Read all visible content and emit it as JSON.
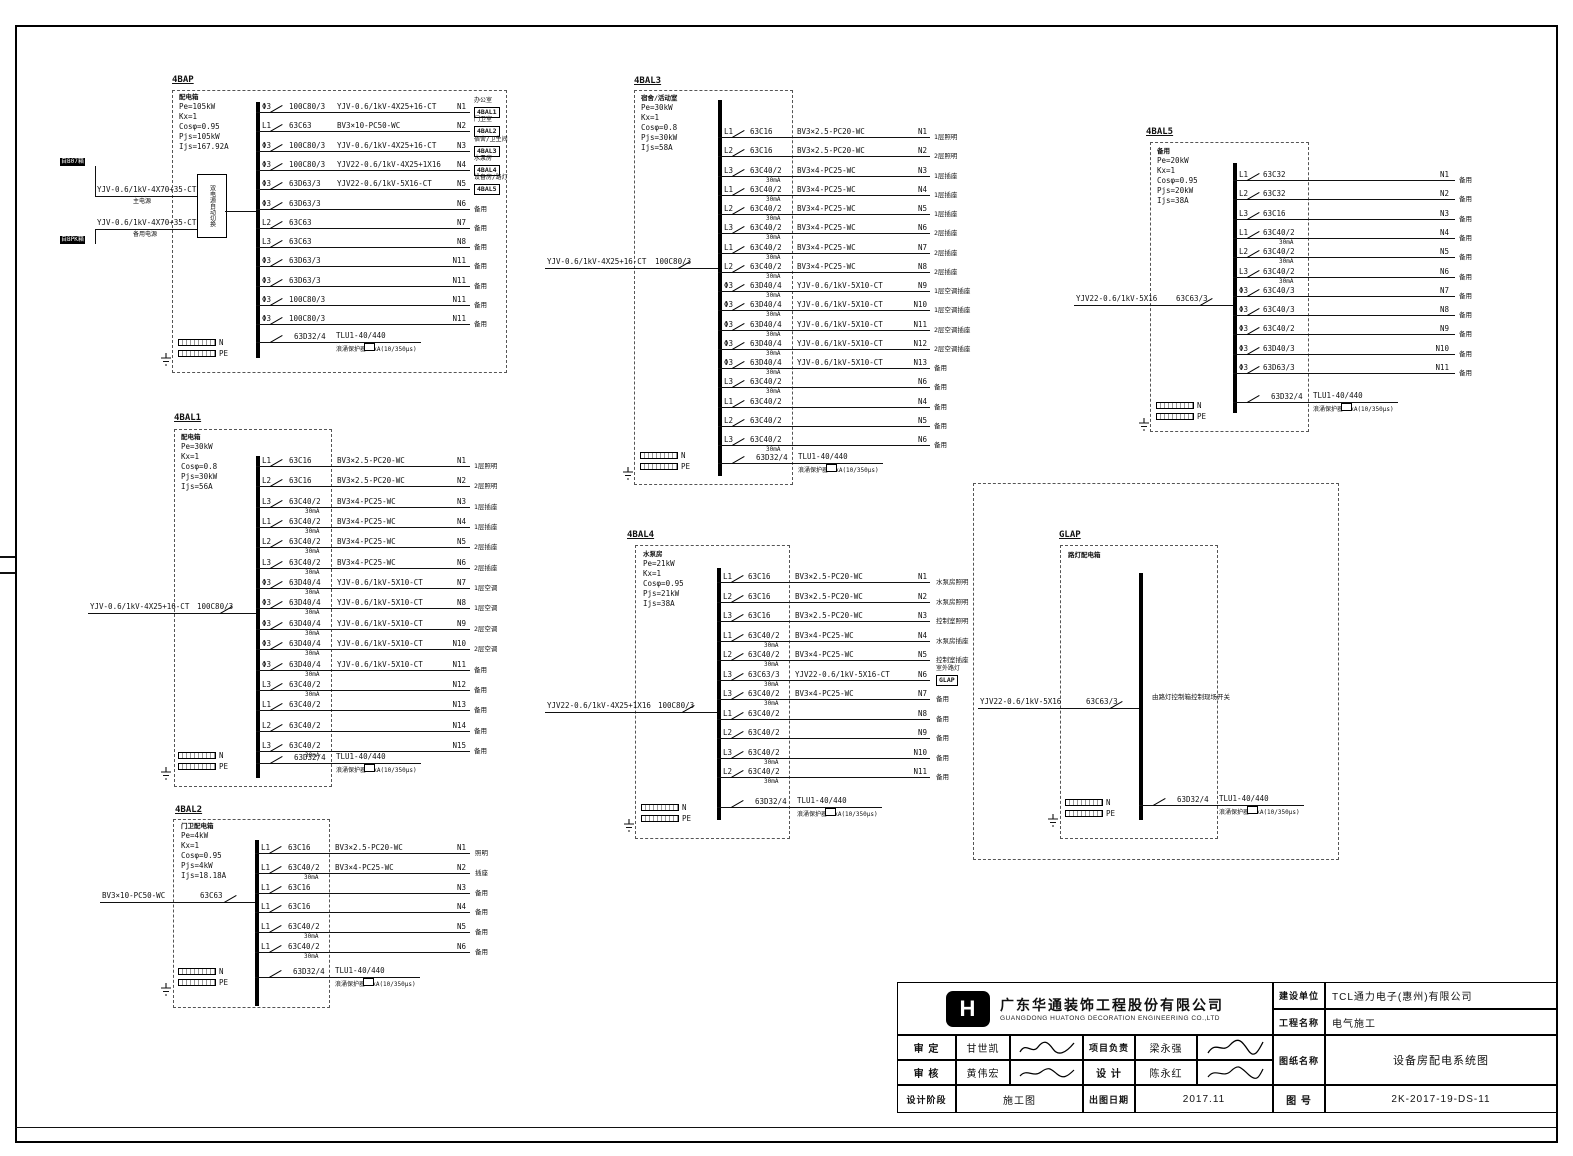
{
  "common": {
    "n": "N",
    "pe": "PE"
  },
  "panels": [
    {
      "id": "4BAP",
      "title": "4BAP",
      "name": "配电箱",
      "header": [
        "Pe=105kW",
        "Kx=1",
        "Cosφ=0.95",
        "Pjs=105kW",
        "Ijs=167.92A"
      ],
      "ats": "双电源自动切换",
      "incoming": [
        {
          "tag": "自B07箱",
          "cable": "YJV-0.6/1kV-4X70+35-CT",
          "note": "主电源"
        },
        {
          "tag": "自BPK箱",
          "cable": "YJV-0.6/1kV-4X70+35-CT",
          "note": "备用电源"
        }
      ],
      "circuits": [
        {
          "ph": "Φ3",
          "br": "100C80/3",
          "cable": "YJV-0.6/1kV-4X25+16-CT",
          "no": "N1",
          "load": "办公室",
          "dest": "4BAL1"
        },
        {
          "ph": "L1",
          "br": "63C63",
          "cable": "BV3×10-PC50-WC",
          "no": "N2",
          "load": "门卫室",
          "dest": "4BAL2"
        },
        {
          "ph": "Φ3",
          "br": "100C80/3",
          "cable": "YJV-0.6/1kV-4X25+16-CT",
          "no": "N3",
          "load": "宿舍/卫生间",
          "dest": "4BAL3"
        },
        {
          "ph": "Φ3",
          "br": "100C80/3",
          "cable": "YJV22-0.6/1kV-4X25+1X16",
          "no": "N4",
          "load": "水泵房",
          "dest": "4BAL4"
        },
        {
          "ph": "Φ3",
          "br": "63D63/3",
          "cable": "YJV22-0.6/1kV-5X16-CT",
          "no": "N5",
          "load": "设备房/路灯",
          "dest": "4BAL5"
        },
        {
          "ph": "Φ3",
          "br": "63D63/3",
          "no": "N6",
          "load": "备用"
        },
        {
          "ph": "L2",
          "br": "63C63",
          "no": "N7",
          "load": "备用"
        },
        {
          "ph": "L3",
          "br": "63C63",
          "no": "N8",
          "load": "备用"
        },
        {
          "ph": "Φ3",
          "br": "63D63/3",
          "no": "N11",
          "load": "备用"
        },
        {
          "ph": "Φ3",
          "br": "63D63/3",
          "no": "N11",
          "load": "备用"
        },
        {
          "ph": "Φ3",
          "br": "100C80/3",
          "no": "N11",
          "load": "备用"
        },
        {
          "ph": "Φ3",
          "br": "100C80/3",
          "no": "N11",
          "load": "备用"
        }
      ],
      "surge": {
        "br": "63D32/4",
        "dev": "TLU1-40/440",
        "note": "浪涌保护器40kA(10/350μs)"
      }
    },
    {
      "id": "4BAL1",
      "title": "4BAL1",
      "name": "配电箱",
      "header": [
        "Pe=30kW",
        "Kx=1",
        "Cosφ=0.8",
        "Pjs=30kW",
        "Ijs=56A"
      ],
      "incoming": [
        {
          "cable": "YJV-0.6/1kV-4X25+16-CT",
          "br": "100C80/3"
        }
      ],
      "circuits": [
        {
          "ph": "L1",
          "br": "63C16",
          "cable": "BV3×2.5-PC20-WC",
          "no": "N1",
          "load": "1层照明"
        },
        {
          "ph": "L2",
          "br": "63C16",
          "cable": "BV3×2.5-PC20-WC",
          "no": "N2",
          "load": "2层照明"
        },
        {
          "ph": "L3",
          "br": "63C40/2",
          "rcd": "30mA",
          "cable": "BV3×4-PC25-WC",
          "no": "N3",
          "load": "1层插座"
        },
        {
          "ph": "L1",
          "br": "63C40/2",
          "rcd": "30mA",
          "cable": "BV3×4-PC25-WC",
          "no": "N4",
          "load": "1层插座"
        },
        {
          "ph": "L2",
          "br": "63C40/2",
          "rcd": "30mA",
          "cable": "BV3×4-PC25-WC",
          "no": "N5",
          "load": "2层插座"
        },
        {
          "ph": "L3",
          "br": "63C40/2",
          "rcd": "30mA",
          "cable": "BV3×4-PC25-WC",
          "no": "N6",
          "load": "2层插座"
        },
        {
          "ph": "Φ3",
          "br": "63D40/4",
          "rcd": "30mA",
          "cable": "YJV-0.6/1kV-5X10-CT",
          "no": "N7",
          "load": "1层空调"
        },
        {
          "ph": "Φ3",
          "br": "63D40/4",
          "rcd": "30mA",
          "cable": "YJV-0.6/1kV-5X10-CT",
          "no": "N8",
          "load": "1层空调"
        },
        {
          "ph": "Φ3",
          "br": "63D40/4",
          "rcd": "30mA",
          "cable": "YJV-0.6/1kV-5X10-CT",
          "no": "N9",
          "load": "2层空调"
        },
        {
          "ph": "Φ3",
          "br": "63D40/4",
          "rcd": "30mA",
          "cable": "YJV-0.6/1kV-5X10-CT",
          "no": "N10",
          "load": "2层空调"
        },
        {
          "ph": "Φ3",
          "br": "63D40/4",
          "rcd": "30mA",
          "cable": "YJV-0.6/1kV-5X10-CT",
          "no": "N11",
          "load": "备用"
        },
        {
          "ph": "L3",
          "br": "63C40/2",
          "rcd": "30mA",
          "no": "N12",
          "load": "备用"
        },
        {
          "ph": "L1",
          "br": "63C40/2",
          "no": "N13",
          "load": "备用"
        },
        {
          "ph": "L2",
          "br": "63C40/2",
          "no": "N14",
          "load": "备用"
        },
        {
          "ph": "L3",
          "br": "63C40/2",
          "rcd": "30mA",
          "no": "N15",
          "load": "备用"
        }
      ],
      "surge": {
        "br": "63D32/4",
        "dev": "TLU1-40/440",
        "note": "浪涌保护器40kA(10/350μs)"
      }
    },
    {
      "id": "4BAL2",
      "title": "4BAL2",
      "name": "门卫配电箱",
      "header": [
        "Pe=4kW",
        "Kx=1",
        "Cosφ=0.95",
        "Pjs=4kW",
        "Ijs=18.18A"
      ],
      "incoming": [
        {
          "cable": "BV3×10-PC50-WC",
          "br": "63C63"
        }
      ],
      "circuits": [
        {
          "ph": "L1",
          "br": "63C16",
          "cable": "BV3×2.5-PC20-WC",
          "no": "N1",
          "load": "照明"
        },
        {
          "ph": "L1",
          "br": "63C40/2",
          "rcd": "30mA",
          "cable": "BV3×4-PC25-WC",
          "no": "N2",
          "load": "插座"
        },
        {
          "ph": "L1",
          "br": "63C16",
          "no": "N3",
          "load": "备用"
        },
        {
          "ph": "L1",
          "br": "63C16",
          "no": "N4",
          "load": "备用"
        },
        {
          "ph": "L1",
          "br": "63C40/2",
          "rcd": "30mA",
          "no": "N5",
          "load": "备用"
        },
        {
          "ph": "L1",
          "br": "63C40/2",
          "rcd": "30mA",
          "no": "N6",
          "load": "备用"
        }
      ],
      "surge": {
        "br": "63D32/4",
        "dev": "TLU1-40/440",
        "note": "浪涌保护器40kA(10/350μs)"
      }
    },
    {
      "id": "4BAL3",
      "title": "4BAL3",
      "name": "宿舍/活动室",
      "header": [
        "Pe=30kW",
        "Kx=1",
        "Cosφ=0.8",
        "Pjs=30kW",
        "Ijs=58A"
      ],
      "incoming": [
        {
          "cable": "YJV-0.6/1kV-4X25+16-CT",
          "br": "100C80/3"
        }
      ],
      "circuits": [
        {
          "ph": "L1",
          "br": "63C16",
          "cable": "BV3×2.5-PC20-WC",
          "no": "N1",
          "load": "1层照明"
        },
        {
          "ph": "L2",
          "br": "63C16",
          "cable": "BV3×2.5-PC20-WC",
          "no": "N2",
          "load": "2层照明"
        },
        {
          "ph": "L3",
          "br": "63C40/2",
          "rcd": "30mA",
          "cable": "BV3×4-PC25-WC",
          "no": "N3",
          "load": "1层插座"
        },
        {
          "ph": "L1",
          "br": "63C40/2",
          "rcd": "30mA",
          "cable": "BV3×4-PC25-WC",
          "no": "N4",
          "load": "1层插座"
        },
        {
          "ph": "L2",
          "br": "63C40/2",
          "rcd": "30mA",
          "cable": "BV3×4-PC25-WC",
          "no": "N5",
          "load": "1层插座"
        },
        {
          "ph": "L3",
          "br": "63C40/2",
          "rcd": "30mA",
          "cable": "BV3×4-PC25-WC",
          "no": "N6",
          "load": "2层插座"
        },
        {
          "ph": "L1",
          "br": "63C40/2",
          "rcd": "30mA",
          "cable": "BV3×4-PC25-WC",
          "no": "N7",
          "load": "2层插座"
        },
        {
          "ph": "L2",
          "br": "63C40/2",
          "rcd": "30mA",
          "cable": "BV3×4-PC25-WC",
          "no": "N8",
          "load": "2层插座"
        },
        {
          "ph": "Φ3",
          "br": "63D40/4",
          "rcd": "30mA",
          "cable": "YJV-0.6/1kV-5X10-CT",
          "no": "N9",
          "load": "1层空调插座"
        },
        {
          "ph": "Φ3",
          "br": "63D40/4",
          "rcd": "30mA",
          "cable": "YJV-0.6/1kV-5X10-CT",
          "no": "N10",
          "load": "1层空调插座"
        },
        {
          "ph": "Φ3",
          "br": "63D40/4",
          "rcd": "30mA",
          "cable": "YJV-0.6/1kV-5X10-CT",
          "no": "N11",
          "load": "2层空调插座"
        },
        {
          "ph": "Φ3",
          "br": "63D40/4",
          "rcd": "30mA",
          "cable": "YJV-0.6/1kV-5X10-CT",
          "no": "N12",
          "load": "2层空调插座"
        },
        {
          "ph": "Φ3",
          "br": "63D40/4",
          "rcd": "30mA",
          "cable": "YJV-0.6/1kV-5X10-CT",
          "no": "N13",
          "load": "备用"
        },
        {
          "ph": "L3",
          "br": "63C40/2",
          "rcd": "30mA",
          "no": "N6",
          "load": "备用"
        },
        {
          "ph": "L1",
          "br": "63C40/2",
          "no": "N4",
          "load": "备用"
        },
        {
          "ph": "L2",
          "br": "63C40/2",
          "no": "N5",
          "load": "备用"
        },
        {
          "ph": "L3",
          "br": "63C40/2",
          "rcd": "30mA",
          "no": "N6",
          "load": "备用"
        }
      ],
      "surge": {
        "br": "63D32/4",
        "dev": "TLU1-40/440",
        "note": "浪涌保护器40kA(10/350μs)"
      }
    },
    {
      "id": "4BAL4",
      "title": "4BAL4",
      "name": "水泵房",
      "header": [
        "Pe=21kW",
        "Kx=1",
        "Cosφ=0.95",
        "Pjs=21kW",
        "Ijs=38A"
      ],
      "incoming": [
        {
          "cable": "YJV22-0.6/1kV-4X25+1X16",
          "br": "100C80/3"
        }
      ],
      "circuits": [
        {
          "ph": "L1",
          "br": "63C16",
          "cable": "BV3×2.5-PC20-WC",
          "no": "N1",
          "load": "水泵房照明"
        },
        {
          "ph": "L2",
          "br": "63C16",
          "cable": "BV3×2.5-PC20-WC",
          "no": "N2",
          "load": "水泵房照明"
        },
        {
          "ph": "L3",
          "br": "63C16",
          "cable": "BV3×2.5-PC20-WC",
          "no": "N3",
          "load": "控制室照明"
        },
        {
          "ph": "L1",
          "br": "63C40/2",
          "rcd": "30mA",
          "cable": "BV3×4-PC25-WC",
          "no": "N4",
          "load": "水泵房插座"
        },
        {
          "ph": "L2",
          "br": "63C40/2",
          "rcd": "30mA",
          "cable": "BV3×4-PC25-WC",
          "no": "N5",
          "load": "控制室插座"
        },
        {
          "ph": "L3",
          "br": "63C63/3",
          "rcd": "30mA",
          "cable": "YJV22-0.6/1kV-5X16-CT",
          "no": "N6",
          "load": "室外路灯",
          "dest": "GLAP"
        },
        {
          "ph": "L3",
          "br": "63C40/2",
          "rcd": "30mA",
          "cable": "BV3×4-PC25-WC",
          "no": "N7",
          "load": "备用"
        },
        {
          "ph": "L1",
          "br": "63C40/2",
          "no": "N8",
          "load": "备用"
        },
        {
          "ph": "L2",
          "br": "63C40/2",
          "no": "N9",
          "load": "备用"
        },
        {
          "ph": "L3",
          "br": "63C40/2",
          "rcd": "30mA",
          "no": "N10",
          "load": "备用"
        },
        {
          "ph": "L2",
          "br": "63C40/2",
          "rcd": "30mA",
          "no": "N11",
          "load": "备用"
        }
      ],
      "surge": {
        "br": "63D32/4",
        "dev": "TLU1-40/440",
        "note": "浪涌保护器40kA(10/350μs)"
      }
    },
    {
      "id": "4BAL5",
      "title": "4BAL5",
      "name": "备用",
      "header": [
        "Pe=20kW",
        "Kx=1",
        "Cosφ=0.95",
        "Pjs=20kW",
        "Ijs=38A"
      ],
      "incoming": [
        {
          "cable": "YJV22-0.6/1kV-5X16",
          "br": "63C63/3"
        }
      ],
      "circuits": [
        {
          "ph": "L1",
          "br": "63C32",
          "no": "N1",
          "load": "备用"
        },
        {
          "ph": "L2",
          "br": "63C32",
          "no": "N2",
          "load": "备用"
        },
        {
          "ph": "L3",
          "br": "63C16",
          "no": "N3",
          "load": "备用"
        },
        {
          "ph": "L1",
          "br": "63C40/2",
          "rcd": "30mA",
          "no": "N4",
          "load": "备用"
        },
        {
          "ph": "L2",
          "br": "63C40/2",
          "rcd": "30mA",
          "no": "N5",
          "load": "备用"
        },
        {
          "ph": "L3",
          "br": "63C40/2",
          "rcd": "30mA",
          "no": "N6",
          "load": "备用"
        },
        {
          "ph": "Φ3",
          "br": "63C40/3",
          "no": "N7",
          "load": "备用"
        },
        {
          "ph": "Φ3",
          "br": "63C40/3",
          "no": "N8",
          "load": "备用"
        },
        {
          "ph": "Φ3",
          "br": "63C40/2",
          "no": "N9",
          "load": "备用"
        },
        {
          "ph": "Φ3",
          "br": "63D40/3",
          "no": "N10",
          "load": "备用"
        },
        {
          "ph": "Φ3",
          "br": "63D63/3",
          "no": "N11",
          "load": "备用"
        }
      ],
      "surge": {
        "br": "63D32/4",
        "dev": "TLU1-40/440",
        "note": "浪涌保护器40kA(10/350μs)"
      }
    },
    {
      "id": "GLAP",
      "title": "GLAP",
      "name": "路灯配电箱",
      "header": [],
      "busNote": "由路灯控制箱控制现场开关",
      "incoming": [
        {
          "cable": "YJV22-0.6/1kV-5X16",
          "br": "63C63/3"
        }
      ],
      "circuits": [],
      "surge": {
        "br": "63D32/4",
        "dev": "TLU1-40/440",
        "note": "浪涌保护器40kA(10/350μs)"
      }
    }
  ],
  "titleblock": {
    "logo_letter": "H",
    "company_cn": "广东华通装饰工程股份有限公司",
    "company_en": "GUANGDONG HUATONG DECORATION ENGINEERING CO.,LTD",
    "shending_label": "审 定",
    "shending_name": "甘世凯",
    "xiangmu_label": "项目负责",
    "xiangmu_name": "梁永强",
    "shenhe_label": "审 核",
    "shenhe_name": "黄伟宏",
    "sheji_label": "设 计",
    "sheji_name": "陈永红",
    "stage_label": "设计阶段",
    "stage_value": "施工图",
    "date_label": "出图日期",
    "date_value": "2017.11",
    "jianshe_label": "建设单位",
    "jianshe_value": "TCL通力电子(惠州)有限公司",
    "gongcheng_label": "工程名称",
    "gongcheng_value": "电气施工",
    "tuzhi_label": "图纸名称",
    "tuzhi_value": "设备房配电系统图",
    "tuhao_label": "图 号",
    "tuhao_value": "2K-2017-19-DS-11"
  }
}
